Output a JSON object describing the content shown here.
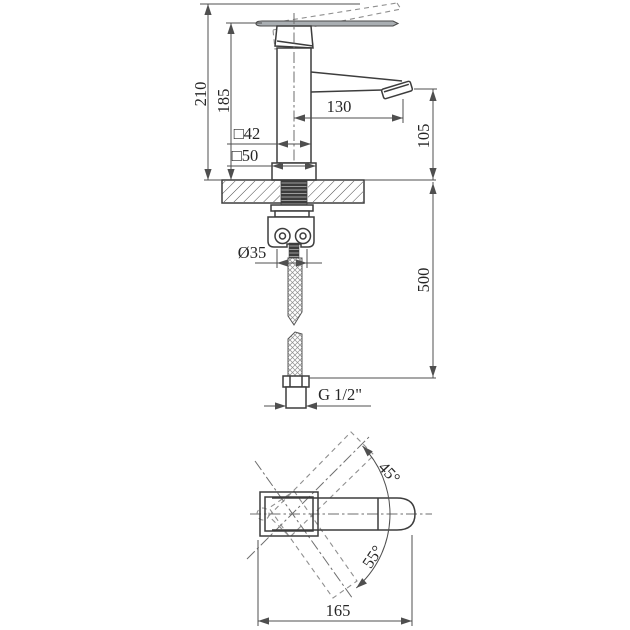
{
  "drawing": {
    "background": "#ffffff",
    "line_color": "#3d3d3d",
    "dimension_color": "#4f4f4f",
    "text_color": "#262626",
    "front_view": {
      "labels": {
        "total_height": "210",
        "lever_height": "185",
        "spout_reach": "130",
        "spout_height": "105",
        "body_section": "□42",
        "base_section": "□50",
        "mounting_hole": "Ø35",
        "hose_length": "500",
        "thread": "G 1/2\""
      }
    },
    "top_view": {
      "labels": {
        "overall_width": "165",
        "handle_swivel_up": "45°",
        "handle_swivel_down": "55°"
      }
    }
  }
}
